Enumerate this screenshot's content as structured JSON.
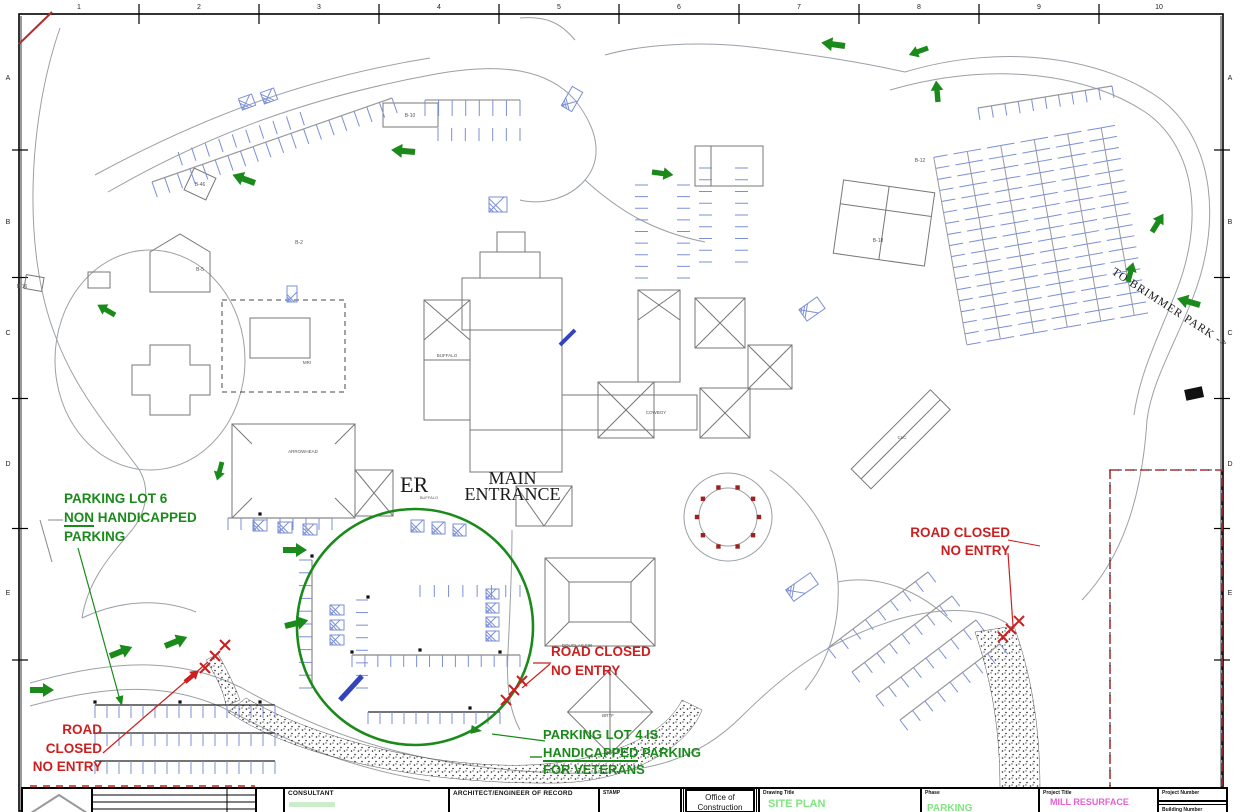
{
  "sheet": {
    "grid_columns": [
      "1",
      "2",
      "3",
      "4",
      "5",
      "6",
      "7",
      "8",
      "9",
      "10"
    ],
    "grid_rows": [
      "A",
      "B",
      "C",
      "D",
      "E"
    ]
  },
  "annotations": {
    "lot6": {
      "line1": "PARKING LOT 6",
      "line2_u": "NON",
      "line2_rest": " HANDICAPPED",
      "line3": "PARKING"
    },
    "road_closed_bottom_left": {
      "line1": "ROAD",
      "line2": "CLOSED",
      "line3": "NO ENTRY"
    },
    "road_closed_center": {
      "line1": "ROAD CLOSED",
      "line2": "NO ENTRY"
    },
    "road_closed_right": {
      "line1": "ROAD CLOSED",
      "line2": "NO ENTRY"
    },
    "lot4": {
      "line1": "PARKING LOT 4 IS",
      "line2_u": "HANDICAPPED",
      "line2_rest": " PARKING",
      "line3": "FOR VETERANS"
    },
    "to_brimmer": "TO BRIMMER PARK ->",
    "er": "ER",
    "main_entrance_line1": "MAIN",
    "main_entrance_line2": "ENTRANCE"
  },
  "building_labels": [
    {
      "t": "BUFFALO",
      "x": 447,
      "y": 357,
      "s": 4.5
    },
    {
      "t": "BUFFALO",
      "x": 429,
      "y": 499,
      "s": 4
    },
    {
      "t": "ARROWHEAD",
      "x": 303,
      "y": 453,
      "s": 4.5
    },
    {
      "t": "MRI",
      "x": 307,
      "y": 364,
      "s": 4.5
    },
    {
      "t": "COWBOY",
      "x": 656,
      "y": 414,
      "s": 4.5
    },
    {
      "t": "CLC",
      "x": 902,
      "y": 439,
      "s": 4.5
    },
    {
      "t": "DOUGLAS FIR",
      "x": 577,
      "y": 647,
      "s": 4.5
    },
    {
      "t": "BRTF",
      "x": 608,
      "y": 717,
      "s": 4.5
    },
    {
      "t": "B-46",
      "x": 200,
      "y": 186,
      "s": 5
    },
    {
      "t": "B-5",
      "x": 200,
      "y": 271,
      "s": 5
    },
    {
      "t": "B-2",
      "x": 299,
      "y": 244,
      "s": 5
    },
    {
      "t": "B-10",
      "x": 410,
      "y": 117,
      "s": 5
    },
    {
      "t": "B-12",
      "x": 920,
      "y": 162,
      "s": 5
    },
    {
      "t": "B-18",
      "x": 878,
      "y": 242,
      "s": 5
    },
    {
      "t": "B-16",
      "x": 22,
      "y": 288,
      "s": 5
    }
  ],
  "title_block": {
    "consultant_label": "CONSULTANT",
    "architect_label": "ARCHITECT/ENGINEER OF RECORD",
    "stamp_label": "STAMP",
    "office_line1": "Office of",
    "office_line2": "Construction",
    "drawing_title_label": "Drawing Title",
    "drawing_title": "SITE PLAN",
    "phase_label": "Phase",
    "phase": "PARKING WAYFINDING",
    "project_title_label": "Project Title",
    "project_title": "MILL RESURFACE",
    "project_number_label": "Project Number",
    "building_number_label": "Building Number"
  },
  "colors": {
    "annotation_green": "#1a8a1a",
    "annotation_red": "#cc1f1f",
    "parking_blue": "#7b8fd6",
    "parking_blue_dark": "#3344bb",
    "linework_gray": "#9aa0a6",
    "building_gray": "#777777",
    "title_green": "#7fe57f",
    "title_magenta": "#e55fd0"
  }
}
